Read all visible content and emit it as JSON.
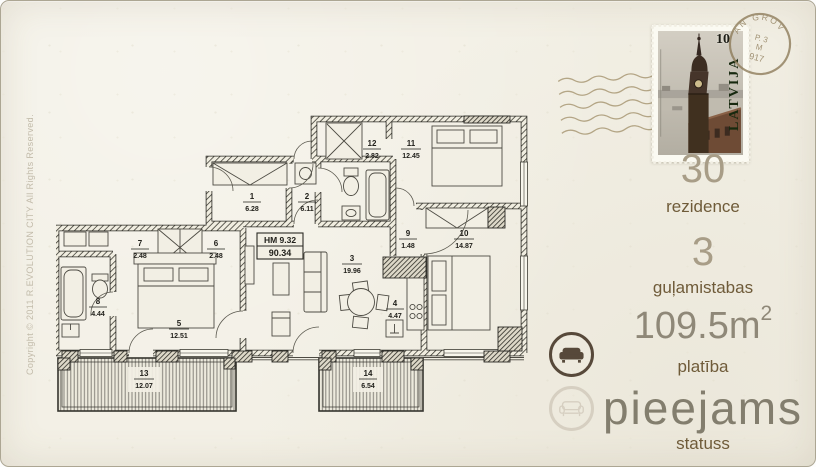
{
  "page": {
    "copyright": "Copyright © 2011 R.EVOLUTION CITY All Rights Reserved.",
    "colors": {
      "paper": "#f2efe4",
      "plan_ink": "#2b2a25",
      "value_text": "#a89d87",
      "label_text": "#6f5b39",
      "status_value_text": "#837e6e",
      "icon_active": "#57493a",
      "icon_inactive": "#d6cfc1"
    }
  },
  "plan": {
    "header_box": {
      "line1": "HM 9.32",
      "line2": "90.34"
    },
    "rooms": [
      {
        "num": "1",
        "area": "6.28"
      },
      {
        "num": "2",
        "area": "6.11"
      },
      {
        "num": "3",
        "area": "19.96"
      },
      {
        "num": "4",
        "area": "4.47"
      },
      {
        "num": "5",
        "area": "12.51"
      },
      {
        "num": "6",
        "area": "2.48"
      },
      {
        "num": "7",
        "area": "2.48"
      },
      {
        "num": "8",
        "area": "4.44"
      },
      {
        "num": "9",
        "area": "1.48"
      },
      {
        "num": "10",
        "area": "14.87"
      },
      {
        "num": "11",
        "area": "12.45"
      },
      {
        "num": "12",
        "area": "2.82"
      },
      {
        "num": "13",
        "area": "12.07"
      },
      {
        "num": "14",
        "area": "6.54"
      }
    ]
  },
  "stamp": {
    "country": "LATVIJA",
    "denomination": "10",
    "postmark": {
      "arc_text": "AN GROV",
      "line1": "P. 3",
      "line2": "M",
      "line3": "917"
    }
  },
  "details": {
    "residence": {
      "value": "30",
      "label": "rezidence"
    },
    "bedrooms": {
      "value": "3",
      "label": "guļamistabas"
    },
    "area": {
      "value": "109.5",
      "unit": "m",
      "exponent": "2",
      "label": "platība"
    },
    "status": {
      "value": "pieejams",
      "label": "statuss"
    }
  },
  "icons": {
    "status_active": "sofa-icon",
    "status_inactive": "sofa-outline-icon"
  }
}
